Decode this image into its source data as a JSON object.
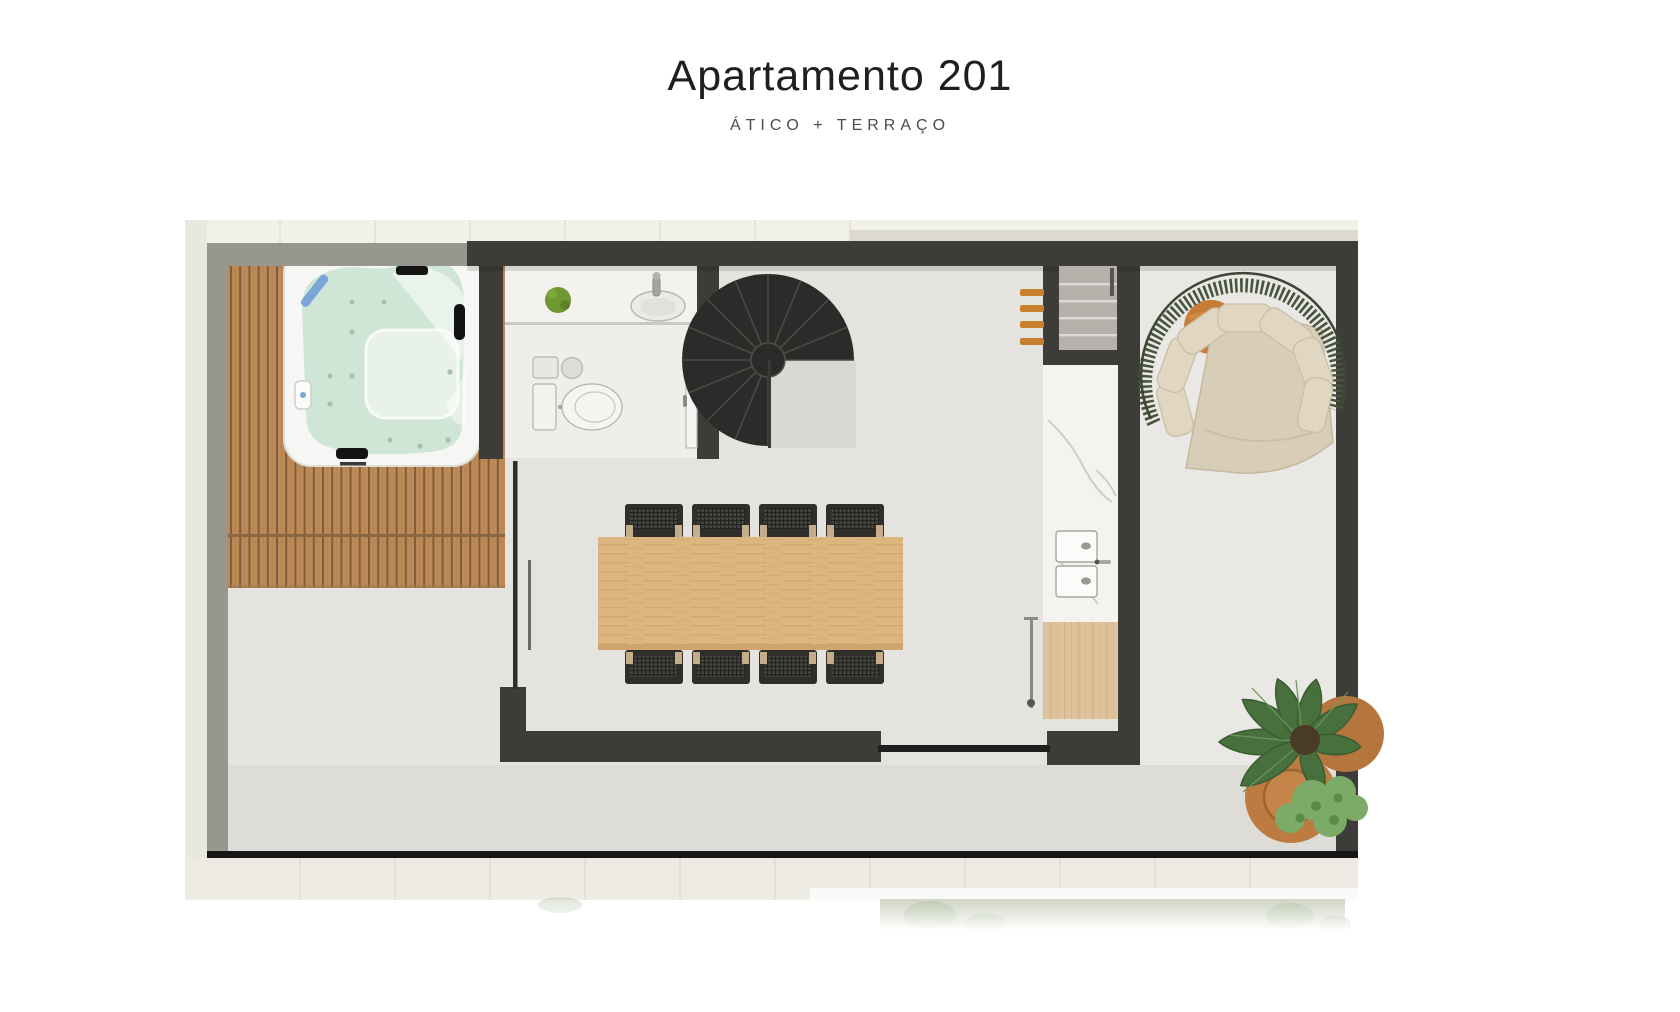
{
  "header": {
    "title": "Apartamento 201",
    "subtitle": "ÁTICO + TERRAÇO"
  },
  "palette": {
    "wall_dark": "#3d3c39",
    "wall_parapet_gray": "#98978f",
    "outer_pale_strip": "#e7e8df",
    "tile_band": "#efeee6",
    "floor_interior": "#e4e3df",
    "floor_living": "#e9e8e4",
    "floor_terrace": "#dedcd7",
    "deck_wood": "#bd8a57",
    "deck_gap": "#7f5d3a",
    "hot_tub_shell": "#f6f6f4",
    "hot_tub_water": "#cfe5d6",
    "stair_dark": "#2c2b29",
    "table_wood": "#dcb57f",
    "chair_dark": "#2f2e2a",
    "chair_arm_beige": "#c3ad8a",
    "counter_marble": "#f4f3f0",
    "cabinet_wood": "#dec29a",
    "ladder_orange": "#c8802f",
    "side_table_orange": "#c77b35",
    "sofa_frame_green": "#49543f",
    "sofa_cushion_beige": "#e0d6c1",
    "plant_leaf_green": "#47703c",
    "plant_light_green": "#7cab67",
    "pot_terracotta": "#bc7b41",
    "bath_plant_green": "#6f9732"
  }
}
